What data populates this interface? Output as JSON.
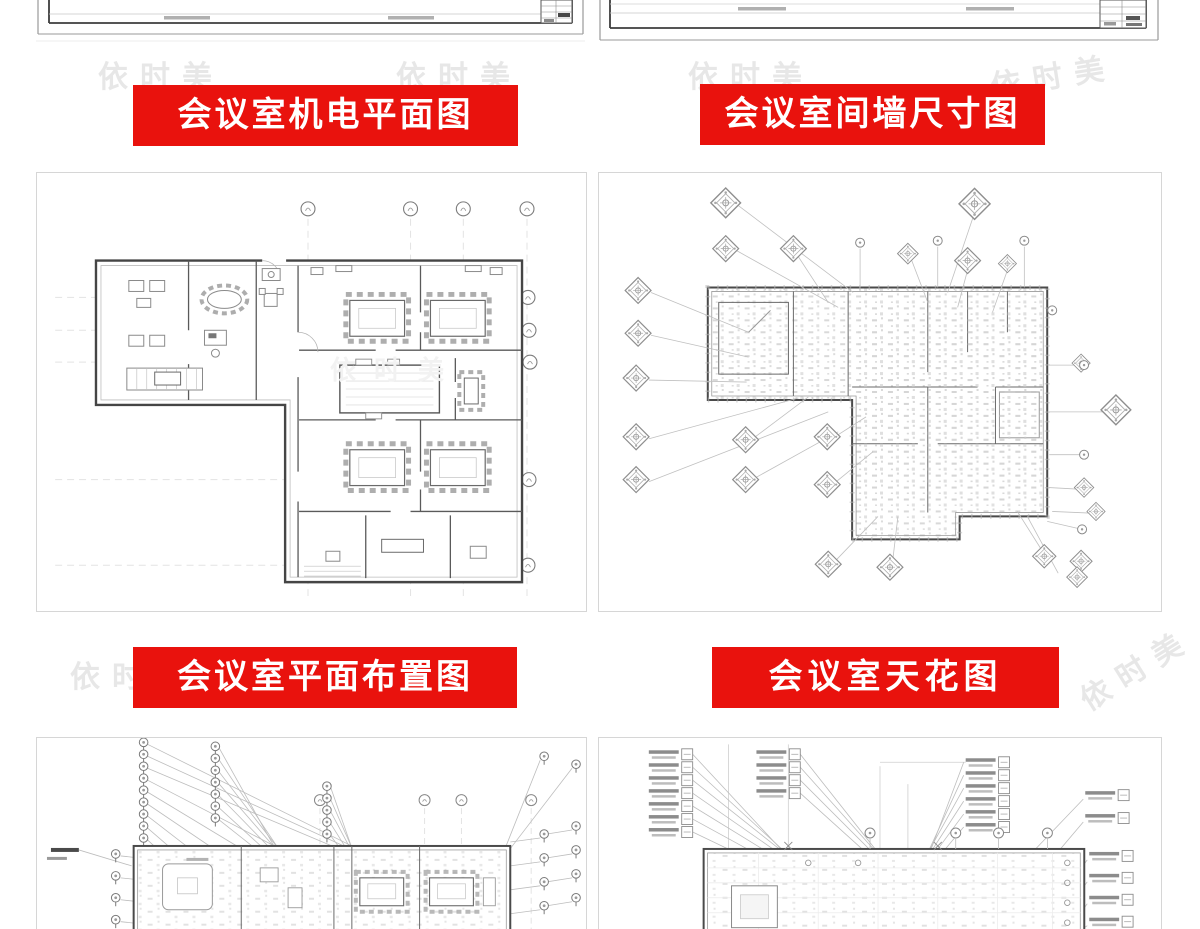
{
  "watermark": {
    "text": "依时美"
  },
  "banners": {
    "mep": "会议室机电平面图",
    "wall": "会议室间墙尺寸图",
    "layout": "会议室平面布置图",
    "ceiling": "会议室天花图"
  },
  "colors": {
    "banner_bg": "#e9120d",
    "banner_text": "#ffffff",
    "watermark": "#e7e7e7"
  },
  "drawings": {
    "top_left_partial": "cad-sheet-bottom-edge",
    "top_right_partial": "cad-sheet-bottom-edge",
    "panel1": "conference-room-mep-floor-plan",
    "panel2": "conference-room-wall-dimension-plan",
    "panel3": "conference-room-furniture-layout-plan",
    "panel4": "conference-room-ceiling-plan"
  }
}
